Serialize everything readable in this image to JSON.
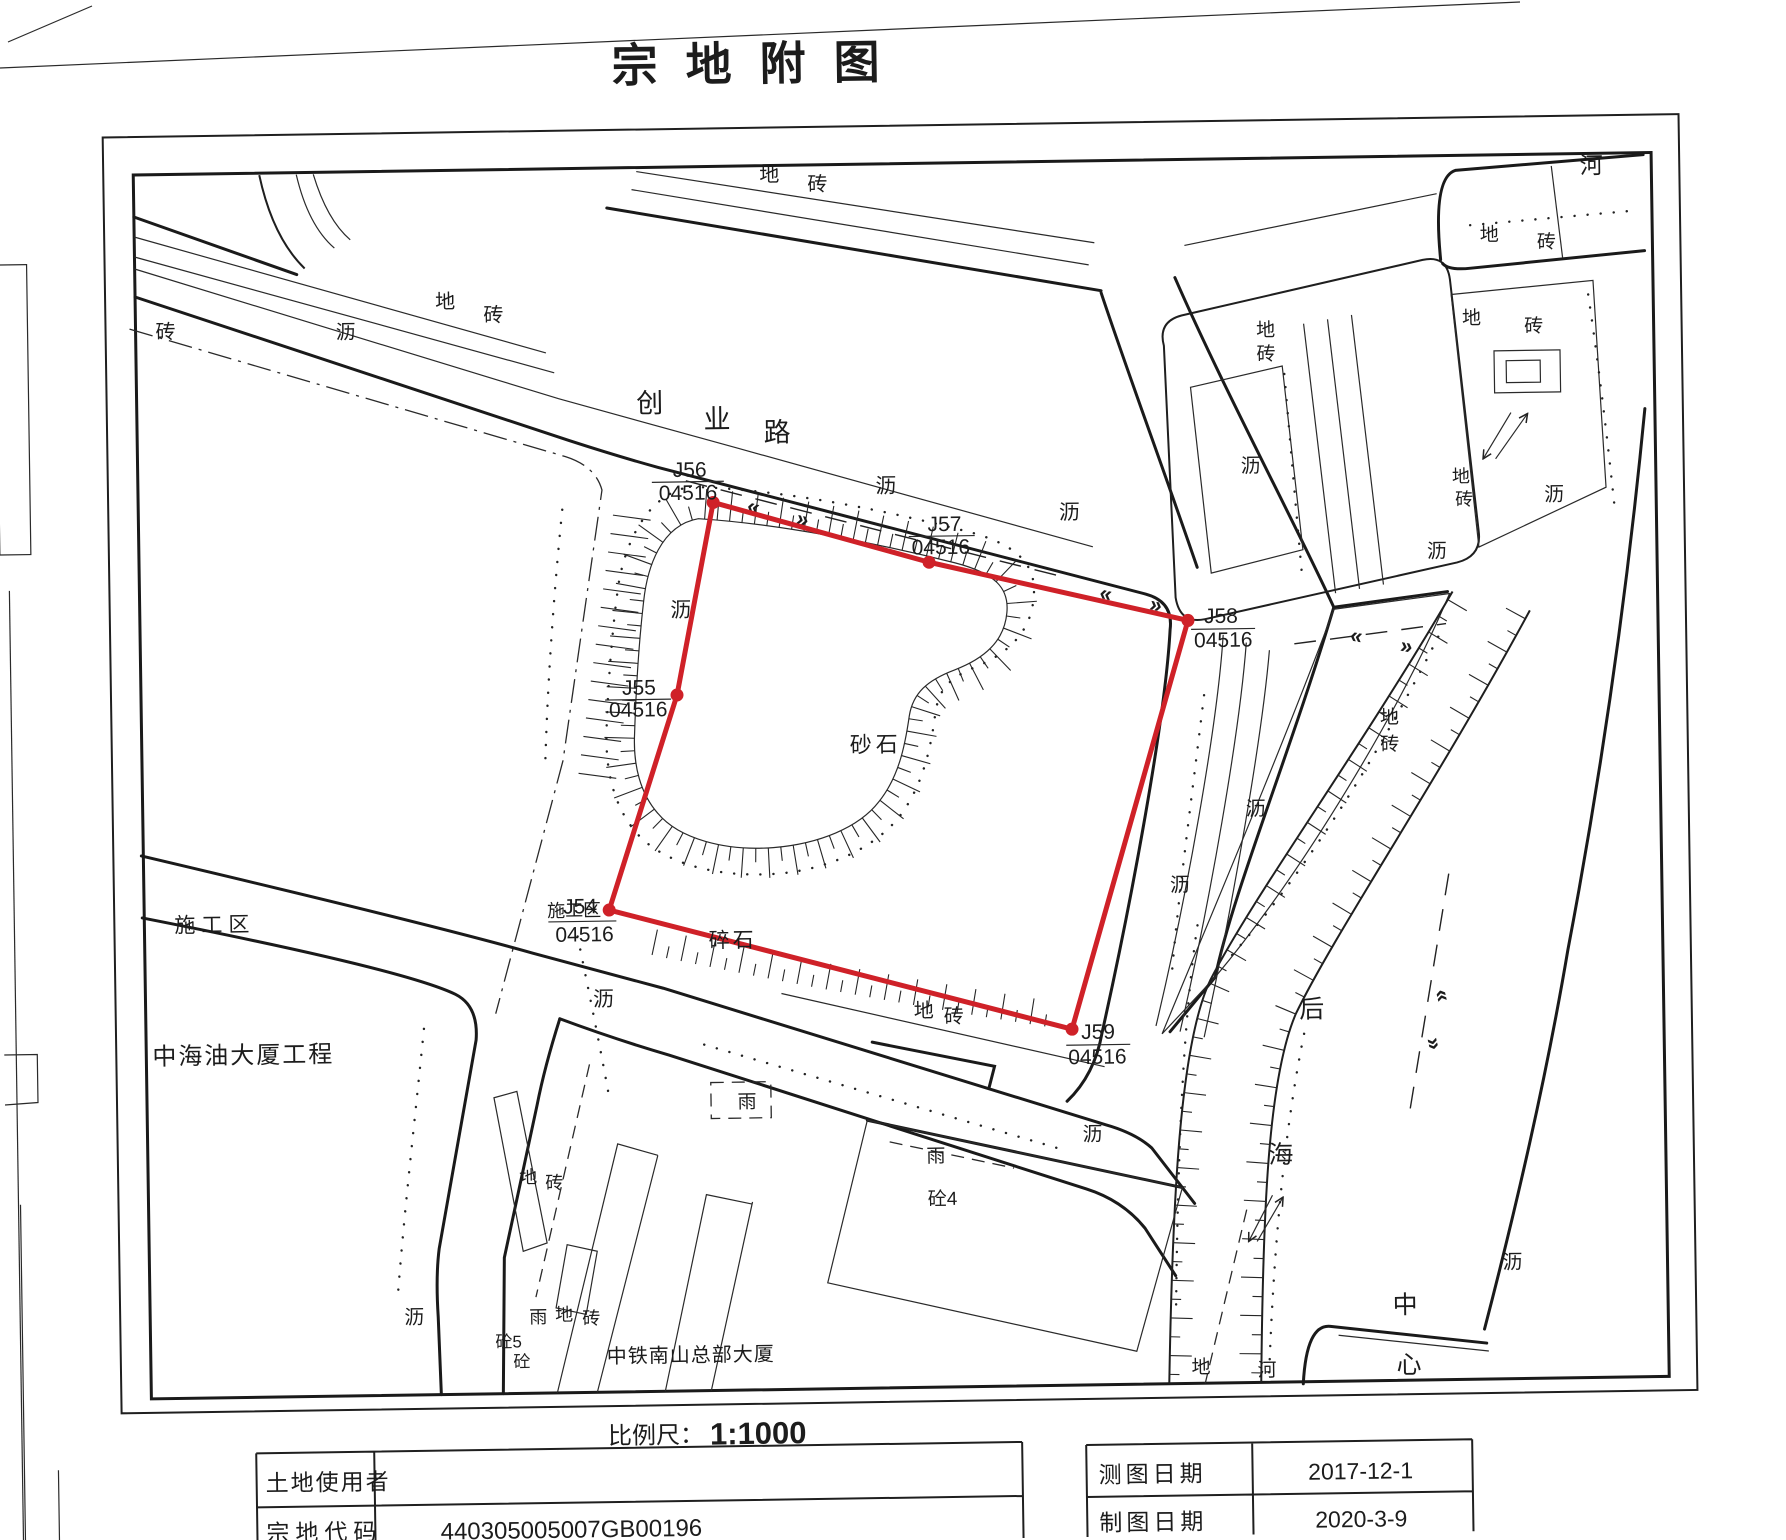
{
  "title": "宗地附图",
  "scale": {
    "label": "比例尺：",
    "value": "1:1000"
  },
  "info_table": {
    "land_user_label": "土地使用者",
    "land_user_value": "",
    "parcel_code_label": "宗地代码",
    "parcel_code_value": "440305005007GB00196"
  },
  "date_table": {
    "survey_label": "测图日期",
    "survey_value": "2017-12-1",
    "draw_label": "制图日期",
    "draw_value": "2020-3-9"
  },
  "map": {
    "road_name_chars": [
      "创",
      "业",
      "路"
    ],
    "parcel_fill_label": "砂石",
    "crushed_stone_label": "碎石",
    "construction_zone_label": "施工区",
    "cnooc_label": "中海油大厦工程",
    "crc_label": "中铁南山总部大厦",
    "canal_chars": {
      "hou": "后",
      "hai": "海",
      "zhong": "中",
      "xin": "心",
      "he": "河"
    },
    "surface": {
      "di": "地",
      "zhuan": "砖",
      "li": "沥",
      "yu": "雨",
      "tong": "砼",
      "tong4": "砼4",
      "tong5": "砼5"
    },
    "boundary_points": [
      {
        "id": "J54",
        "code": "04516"
      },
      {
        "id": "J55",
        "code": "04516"
      },
      {
        "id": "J56",
        "code": "04516"
      },
      {
        "id": "J57",
        "code": "04516"
      },
      {
        "id": "J58",
        "code": "04516"
      },
      {
        "id": "J59",
        "code": "04516"
      }
    ],
    "road_arrows": {
      "left": "«",
      "right": "»"
    },
    "colors": {
      "parcel_boundary": "#cf2128",
      "ink": "#1c1c1c"
    }
  }
}
